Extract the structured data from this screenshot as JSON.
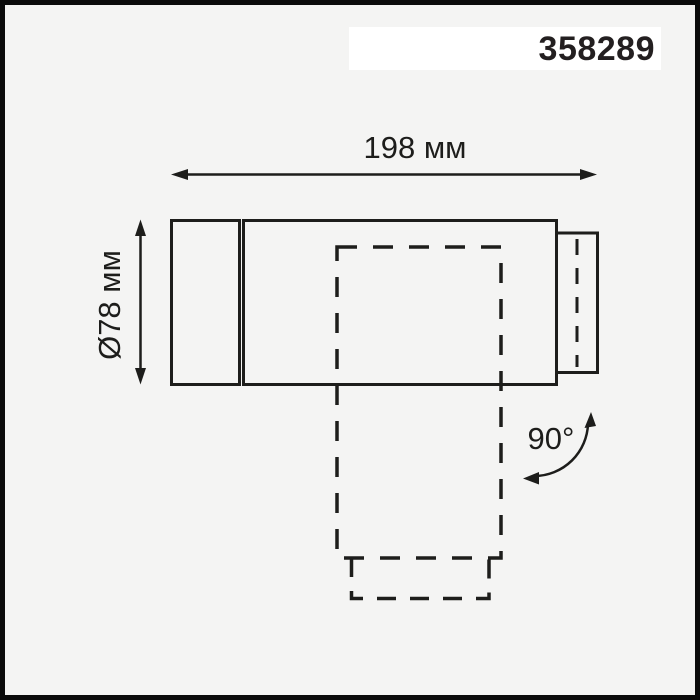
{
  "page": {
    "background_color": "#f4f4f3",
    "frame_color": "#0b0b0b",
    "line_color": "#1d1d1b",
    "badge_background": "#ffffff"
  },
  "header": {
    "article_number": "358289"
  },
  "drawing": {
    "type": "technical-dimension-drawing",
    "length_dimension": {
      "label": "198 мм",
      "value_mm": 198
    },
    "diameter_dimension": {
      "label": "Ø78 мм",
      "value_mm": 78
    },
    "rotation": {
      "label": "90°",
      "value_degrees": 90
    }
  }
}
